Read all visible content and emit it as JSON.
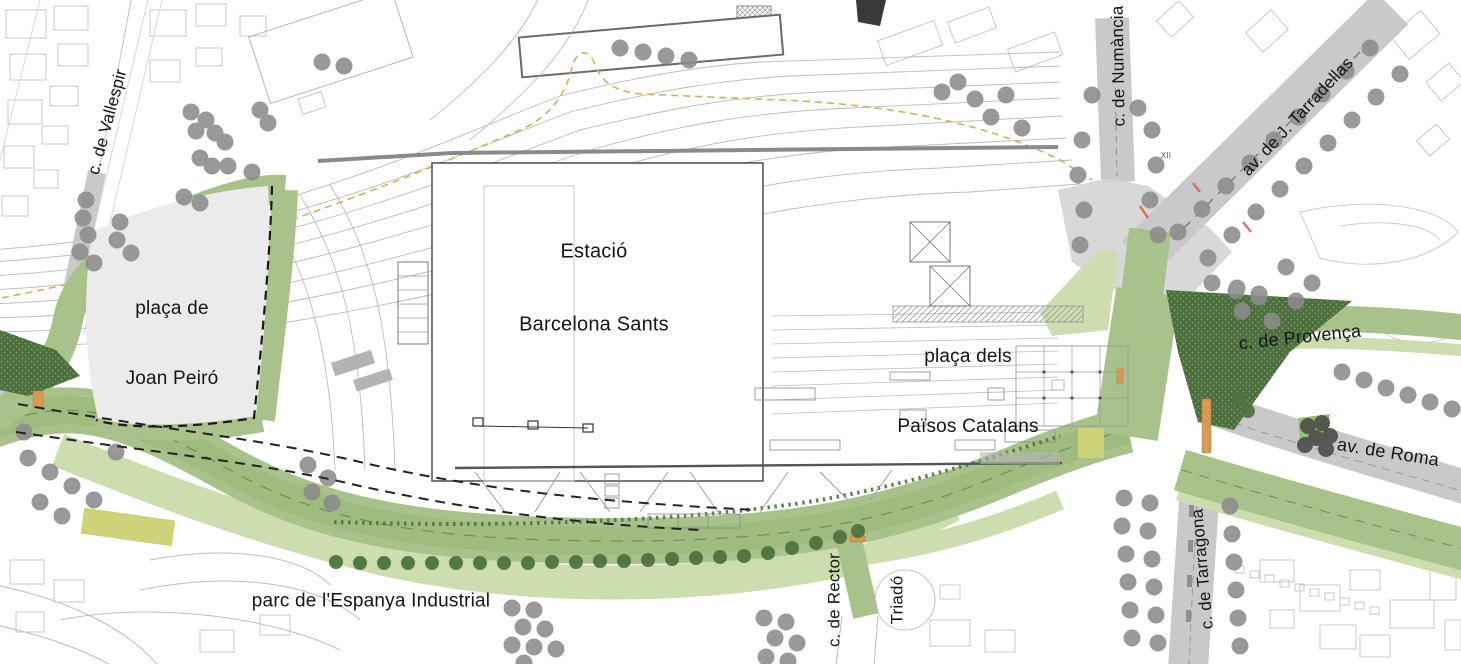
{
  "labels": {
    "station": {
      "line1": "Estació",
      "line2": "Barcelona Sants"
    },
    "placa_joan_peiro": {
      "line1": "plaça de",
      "line2": "Joan Peiró"
    },
    "placa_paisos_catalans": {
      "line1": "plaça dels",
      "line2": "Països Catalans"
    },
    "parc_espanya_industrial": "parc de l'Espanya Industrial",
    "carrer_vallespir": "c. de Vallespir",
    "carrer_numancia": "c. de Numància",
    "avinguda_tarradellas": "av. de J. Tarradellas",
    "carrer_provenca": "c. de Provença",
    "avinguda_roma": "av. de Roma",
    "carrer_tarragona": "c. de Tarragona",
    "carrer_rector_triado": {
      "line1": "c. de Rector",
      "line2": "Triadó"
    },
    "xii": "XII"
  },
  "colors": {
    "green-mid": "#a9c28b",
    "green-mid2": "#9fbb80",
    "green-light": "#cdddb0",
    "green-dark": "#4d6f3f",
    "green-dark-dot": "#7ba163",
    "green-bright": "#8fc468",
    "green-line": "#6f8f55",
    "green-tree": "#4e7440",
    "gray-tree": "#8c8c8c",
    "dark-tree": "#4e4e4e",
    "road": "#c9c9c9",
    "road-light": "#d4d4d4",
    "fabric": "#c8c8c8",
    "rail": "#a5a5a5",
    "station-line": "#3f3f3f",
    "plaza": "#ebebeb",
    "orange-route": "#ddac5a",
    "orange-stop": "#d79a55",
    "red-mark": "#e05c5c",
    "yellow-green": "#ccd378",
    "label": "#151515"
  },
  "map": {
    "gray_trees": [
      [
        86,
        200
      ],
      [
        83,
        218
      ],
      [
        88,
        235
      ],
      [
        80,
        252
      ],
      [
        94,
        263
      ],
      [
        120,
        222
      ],
      [
        117,
        240
      ],
      [
        131,
        253
      ],
      [
        191,
        112
      ],
      [
        206,
        120
      ],
      [
        215,
        133
      ],
      [
        196,
        131
      ],
      [
        200,
        158
      ],
      [
        212,
        166
      ],
      [
        184,
        197
      ],
      [
        200,
        203
      ],
      [
        228,
        166
      ],
      [
        252,
        172
      ],
      [
        260,
        110
      ],
      [
        268,
        123
      ],
      [
        225,
        142
      ],
      [
        322,
        62
      ],
      [
        344,
        66
      ],
      [
        620,
        48
      ],
      [
        643,
        52
      ],
      [
        666,
        56
      ],
      [
        689,
        60
      ],
      [
        942,
        92
      ],
      [
        958,
        82
      ],
      [
        975,
        99
      ],
      [
        991,
        117
      ],
      [
        1006,
        95
      ],
      [
        1022,
        128
      ],
      [
        1092,
        95
      ],
      [
        1138,
        108
      ],
      [
        1082,
        140
      ],
      [
        1078,
        175
      ],
      [
        1084,
        210
      ],
      [
        1080,
        245
      ],
      [
        1152,
        130
      ],
      [
        1156,
        165
      ],
      [
        1150,
        200
      ],
      [
        1158,
        235
      ],
      [
        1178,
        232
      ],
      [
        1202,
        209
      ],
      [
        1226,
        186
      ],
      [
        1250,
        163
      ],
      [
        1274,
        140
      ],
      [
        1298,
        117
      ],
      [
        1322,
        94
      ],
      [
        1346,
        71
      ],
      [
        1370,
        48
      ],
      [
        1208,
        258
      ],
      [
        1232,
        235
      ],
      [
        1256,
        212
      ],
      [
        1280,
        189
      ],
      [
        1304,
        166
      ],
      [
        1328,
        143
      ],
      [
        1352,
        120
      ],
      [
        1376,
        97
      ],
      [
        1400,
        74
      ],
      [
        1212,
        283
      ],
      [
        1236,
        291
      ],
      [
        1259,
        297
      ],
      [
        1242,
        311
      ],
      [
        1272,
        321
      ],
      [
        1296,
        301
      ],
      [
        1286,
        267
      ],
      [
        1312,
        283
      ],
      [
        1342,
        372
      ],
      [
        1364,
        380
      ],
      [
        1386,
        388
      ],
      [
        1408,
        395
      ],
      [
        1430,
        402
      ],
      [
        1452,
        409
      ],
      [
        1124,
        498
      ],
      [
        1150,
        503
      ],
      [
        1122,
        526
      ],
      [
        1148,
        531
      ],
      [
        1126,
        554
      ],
      [
        1152,
        559
      ],
      [
        1128,
        582
      ],
      [
        1154,
        587
      ],
      [
        1130,
        610
      ],
      [
        1156,
        615
      ],
      [
        1132,
        638
      ],
      [
        1158,
        643
      ],
      [
        1230,
        506
      ],
      [
        1232,
        534
      ],
      [
        1234,
        562
      ],
      [
        1236,
        590
      ],
      [
        1238,
        618
      ],
      [
        1240,
        646
      ],
      [
        512,
        608
      ],
      [
        534,
        610
      ],
      [
        523,
        627
      ],
      [
        545,
        629
      ],
      [
        512,
        645
      ],
      [
        534,
        647
      ],
      [
        556,
        649
      ],
      [
        524,
        663
      ],
      [
        764,
        618
      ],
      [
        786,
        622
      ],
      [
        775,
        638
      ],
      [
        797,
        643
      ],
      [
        766,
        657
      ],
      [
        788,
        661
      ],
      [
        28,
        458
      ],
      [
        50,
        472
      ],
      [
        72,
        486
      ],
      [
        94,
        500
      ],
      [
        40,
        502
      ],
      [
        62,
        516
      ],
      [
        24,
        432
      ],
      [
        116,
        452
      ],
      [
        308,
        465
      ],
      [
        328,
        478
      ],
      [
        312,
        492
      ],
      [
        332,
        503
      ],
      [
        1237,
        288
      ],
      [
        1259,
        294
      ]
    ],
    "green_trees": [
      [
        336,
        562
      ],
      [
        360,
        563
      ],
      [
        384,
        563
      ],
      [
        408,
        563
      ],
      [
        432,
        563
      ],
      [
        456,
        563
      ],
      [
        480,
        563
      ],
      [
        504,
        563
      ],
      [
        528,
        563
      ],
      [
        552,
        562
      ],
      [
        576,
        562
      ],
      [
        600,
        561
      ],
      [
        624,
        561
      ],
      [
        648,
        560
      ],
      [
        672,
        559
      ],
      [
        696,
        558
      ],
      [
        720,
        557
      ],
      [
        744,
        556
      ],
      [
        768,
        553
      ],
      [
        792,
        548
      ],
      [
        816,
        543
      ],
      [
        840,
        537
      ],
      [
        858,
        531
      ],
      [
        1240,
        398
      ],
      [
        1248,
        411
      ]
    ],
    "dark_trees": [
      [
        1308,
        426
      ],
      [
        1322,
        423
      ],
      [
        1316,
        438
      ],
      [
        1330,
        436
      ],
      [
        1305,
        445
      ],
      [
        1326,
        449
      ]
    ]
  }
}
